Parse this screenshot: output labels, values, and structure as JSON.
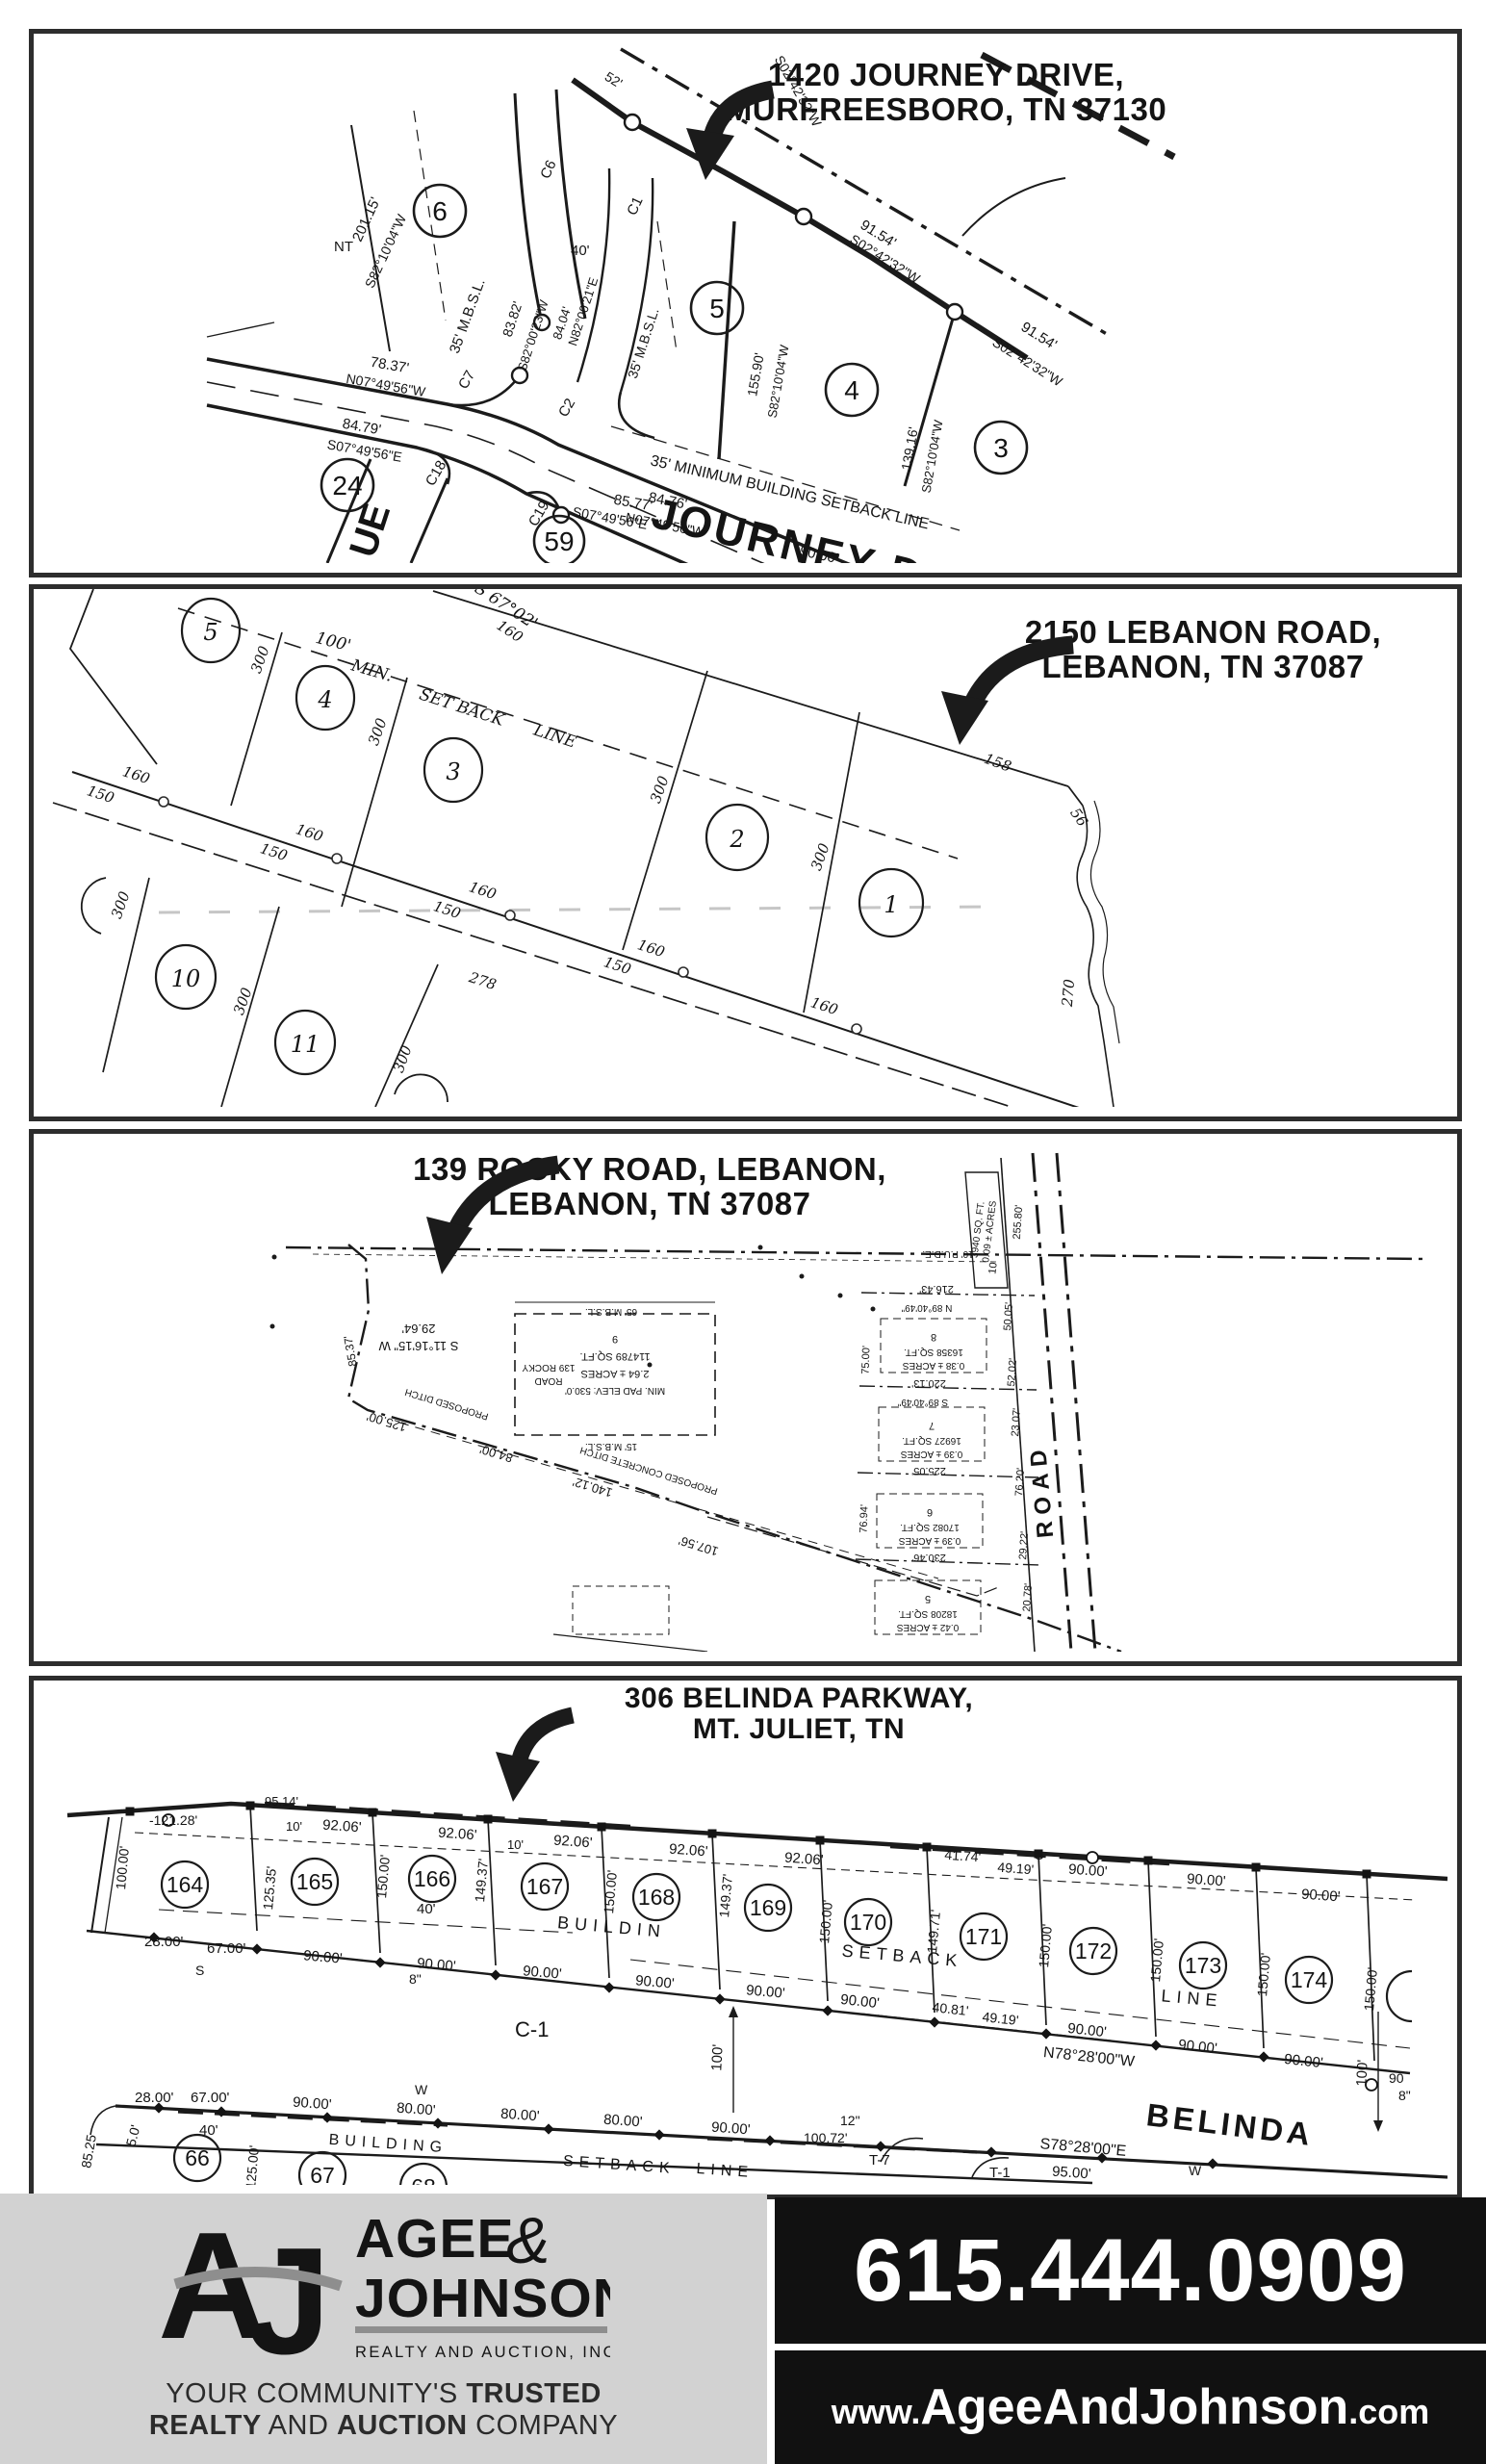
{
  "panel1": {
    "address1": "1420 JOURNEY DRIVE,",
    "address2": "MURFREESBORO, TN 37130",
    "street": "JOURNEY DRIVE",
    "avenue_partial": "UE",
    "lots": {
      "l6": "6",
      "l5": "5",
      "l4": "4",
      "l3": "3",
      "l24": "24",
      "l59": "59"
    },
    "dims": {
      "d20115": "201.15'",
      "s8210": "S82°10'04\"W",
      "nt": "NT",
      "mbsl": "35' M.B.S.L.",
      "c6": "C6",
      "c1": "C1",
      "c2": "C2",
      "c7": "C7",
      "c18": "C18",
      "c19": "C19",
      "d8382": "83.82'",
      "s8200": "S82°00'23\"W",
      "n8200": "N82°00'21\"E",
      "d8404": "84.04'",
      "d40": "40'",
      "s0242": "S02°42'32\"W",
      "d9154": "91.54'",
      "d52": "52'",
      "d15590": "155.90'",
      "d13916": "139.16'",
      "setback": "35' MINIMUM BUILDING SETBACK LINE",
      "d8476": "84.76'",
      "n0749": "N07°49'56\"W",
      "d9000": "90.00'",
      "d7837": "78.37'",
      "d8479": "84.79'",
      "s0749": "S07°49'56\"E",
      "d8577": "85.77'"
    }
  },
  "panel2": {
    "address1": "2150 LEBANON ROAD,",
    "address2": "LEBANON, TN 37087",
    "lots": {
      "l5": "5",
      "l4": "4",
      "l3": "3",
      "l2": "2",
      "l1": "1",
      "l10": "10",
      "l11": "11"
    },
    "dims": {
      "bearing": "S 67°02'",
      "d100": "100'",
      "min": "MIN.",
      "setback": "SET BACK",
      "line": "LINE",
      "d300": "300",
      "d160": "160",
      "d150": "150",
      "d158": "158",
      "d56": "56",
      "d270": "270",
      "d278": "278"
    }
  },
  "panel3": {
    "address1": "139 ROCKY ROAD, LEBANON,",
    "address2": "LEBANON, TN 37087",
    "road": "ROAD",
    "main_lot": {
      "num": "9",
      "sqft": "114789 SQ.FT.",
      "acres": "2.64 ± ACRES",
      "addr1": "139 ROCKY",
      "addr2": "ROAD",
      "elev": "MIN. PAD ELEV: 530.0'",
      "mbsl": "65' M.B.S.L.",
      "mbsl2": "15' M.B.S.L."
    },
    "dims": {
      "d2964": "29.64'",
      "s1116": "S 11°16'15\" W",
      "d8537": "85.37'",
      "d12500": "125.00'",
      "d8400": "84.00'",
      "d14012": "140.12'",
      "d10756": "107.56'",
      "ditch": "PROPOSED DITCH",
      "cditch": "PROPOSED CONCRETE DITCH",
      "d25580": "255.80'",
      "d5005": "50.05'",
      "d5202": "52.02'",
      "d2307": "23.07'",
      "d7620": "76.20'",
      "d2922": "29.22'",
      "d2078": "20.78'",
      "d21643": "216.43'",
      "n8940": "N 89°40'49\"",
      "d22013": "220.13'",
      "s8940": "S 89°40'49\"",
      "d22505": "225.05'",
      "d23046": "230.46'",
      "d7500": "75.00'",
      "d7694": "76.94'",
      "pude": "10' P.U.D.E."
    },
    "lots": {
      "lot10": {
        "num": "10",
        "sqft": "3940 SQ. FT.",
        "acres": "0.09 ± ACRES"
      },
      "lot8": {
        "num": "8",
        "sqft": "16358 SQ.FT.",
        "acres": "0.38 ± ACRES"
      },
      "lot7": {
        "num": "7",
        "sqft": "16927 SQ.FT.",
        "acres": "0.39 ± ACRES"
      },
      "lot6": {
        "num": "6",
        "sqft": "17082 SQ.FT.",
        "acres": "0.39 ± ACRES"
      },
      "lot5": {
        "num": "5",
        "sqft": "18208 SQ.FT.",
        "acres": "0.42 ± ACRES"
      }
    }
  },
  "panel4": {
    "address1": "306 BELINDA PARKWAY,",
    "address2": "MT. JULIET, TN",
    "street": "BELINDA",
    "lots_top": [
      "164",
      "165",
      "166",
      "167",
      "168",
      "169",
      "170",
      "171",
      "172",
      "173",
      "174"
    ],
    "lots_bottom": [
      "66",
      "67",
      "68"
    ],
    "dims": {
      "d12128": "-121.28'",
      "d9514": "95.14'",
      "d10": "10'",
      "d9206": "92.06'",
      "d10000": "100.00'",
      "d12535": "125.35'",
      "d15000": "150.00'",
      "d14937": "149.37'",
      "d14971": "149.71'",
      "d40": "40'",
      "d4174": "41.74'",
      "d4919": "49.19'",
      "building": "BUILDING",
      "buildin": "BUILDIN",
      "setback": "SETBACK",
      "line": "LINE",
      "d2800": "28.00'",
      "d6700": "67.00'",
      "d9000": "90.00'",
      "d90": "90",
      "d8": "8\"",
      "c1": "C-1",
      "d100": "100'",
      "d4081": "40.81'",
      "n7828": "N78°28'00\"W",
      "s7828": "S78°28'00\"E",
      "t7": "T-7",
      "t1": "T-1",
      "d12": "12\"",
      "d10072": "100.72'",
      "d9500": "95.00'",
      "d8000": "80.00'",
      "d12500": "125.00'",
      "d50": "5.0'",
      "d8525": "85.25",
      "w": "W",
      "s": "S"
    }
  },
  "footer": {
    "monogram_a": "A",
    "monogram_j": "J",
    "name1": "AGEE",
    "amp": "&",
    "name2": "JOHNSON",
    "subtitle": "REALTY AND AUCTION, INC.",
    "tag1a": "YOUR COMMUNITY'S ",
    "tag1b": "TRUSTED",
    "tag2a": "REALTY",
    "tag2b": " AND ",
    "tag2c": "AUCTION",
    "tag2d": " COMPANY",
    "phone": "615.444.0909",
    "web1": "www.",
    "web2": "AgeeAndJohnson",
    "web3": ".com",
    "colors": {
      "gray_bg": "#d2d2d2",
      "black_bg": "#111111",
      "logo_gray": "#8e8e8e",
      "ink": "#1c1c1c"
    }
  }
}
